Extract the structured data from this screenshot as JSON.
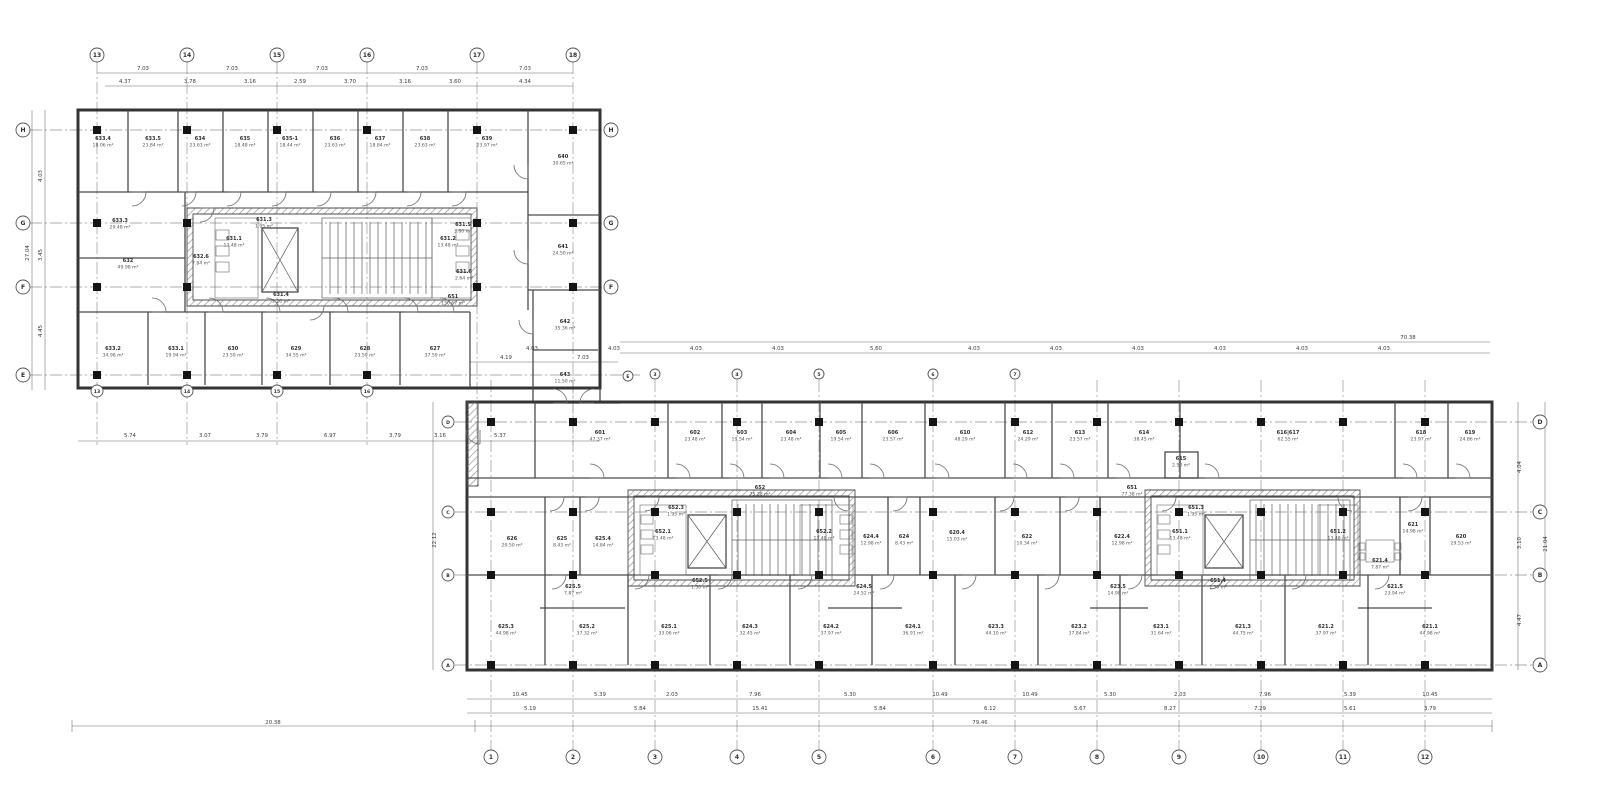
{
  "plan": {
    "rooms": [
      {
        "id": "633.4",
        "area": "18.06 m²",
        "x": 103,
        "y": 140
      },
      {
        "id": "633.5",
        "area": "23.84 m²",
        "x": 153,
        "y": 140
      },
      {
        "id": "634",
        "area": "23.63 m²",
        "x": 200,
        "y": 140
      },
      {
        "id": "635",
        "area": "18.48 m²",
        "x": 245,
        "y": 140
      },
      {
        "id": "635-1",
        "area": "18.44 m²",
        "x": 290,
        "y": 140
      },
      {
        "id": "636",
        "area": "23.63 m²",
        "x": 335,
        "y": 140
      },
      {
        "id": "637",
        "area": "18.84 m²",
        "x": 380,
        "y": 140
      },
      {
        "id": "638",
        "area": "23.63 m²",
        "x": 425,
        "y": 140
      },
      {
        "id": "639",
        "area": "23.97 m²",
        "x": 487,
        "y": 140
      },
      {
        "id": "640",
        "area": "30.65 m²",
        "x": 563,
        "y": 158
      },
      {
        "id": "633.3",
        "area": "29.48 m²",
        "x": 120,
        "y": 222
      },
      {
        "id": "632",
        "area": "49.98 m²",
        "x": 128,
        "y": 262
      },
      {
        "id": "632.6",
        "area": "7.84 m²",
        "x": 201,
        "y": 258
      },
      {
        "id": "631.1",
        "area": "13.48 m²",
        "x": 234,
        "y": 240
      },
      {
        "id": "631.2",
        "area": "13.48 m²",
        "x": 448,
        "y": 240
      },
      {
        "id": "631.3",
        "area": "1.95 m²",
        "x": 264,
        "y": 221
      },
      {
        "id": "631.4",
        "area": "1.20 m²",
        "x": 281,
        "y": 296
      },
      {
        "id": "631.5",
        "area": "3.80 m²",
        "x": 463,
        "y": 226
      },
      {
        "id": "631.6",
        "area": "2.64 m²",
        "x": 464,
        "y": 273
      },
      {
        "id": "651",
        "area": "130.67 m²",
        "x": 453,
        "y": 298
      },
      {
        "id": "633.2",
        "area": "34.98 m²",
        "x": 113,
        "y": 350
      },
      {
        "id": "633.1",
        "area": "19.94 m²",
        "x": 176,
        "y": 350
      },
      {
        "id": "630",
        "area": "23.59 m²",
        "x": 233,
        "y": 350
      },
      {
        "id": "629",
        "area": "34.55 m²",
        "x": 296,
        "y": 350
      },
      {
        "id": "628",
        "area": "23.59 m²",
        "x": 365,
        "y": 350
      },
      {
        "id": "627",
        "area": "37.59 m²",
        "x": 435,
        "y": 350
      },
      {
        "id": "641",
        "area": "24.50 m²",
        "x": 563,
        "y": 248
      },
      {
        "id": "642",
        "area": "35.36 m²",
        "x": 565,
        "y": 323
      },
      {
        "id": "643",
        "area": "11.50 m²",
        "x": 565,
        "y": 376
      },
      {
        "id": "601",
        "area": "47.37 m²",
        "x": 600,
        "y": 434
      },
      {
        "id": "602",
        "area": "23.48 m²",
        "x": 695,
        "y": 434
      },
      {
        "id": "603",
        "area": "19.54 m²",
        "x": 742,
        "y": 434
      },
      {
        "id": "604",
        "area": "23.48 m²",
        "x": 791,
        "y": 434
      },
      {
        "id": "605",
        "area": "19.54 m²",
        "x": 841,
        "y": 434
      },
      {
        "id": "606",
        "area": "23.57 m²",
        "x": 893,
        "y": 434
      },
      {
        "id": "610",
        "area": "48.29 m²",
        "x": 965,
        "y": 434
      },
      {
        "id": "612",
        "area": "24.29 m²",
        "x": 1028,
        "y": 434
      },
      {
        "id": "613",
        "area": "23.57 m²",
        "x": 1080,
        "y": 434
      },
      {
        "id": "614",
        "area": "38.45 m²",
        "x": 1144,
        "y": 434
      },
      {
        "id": "615",
        "area": "2.50 m²",
        "x": 1181,
        "y": 460
      },
      {
        "id": "616|617",
        "area": "62.55 m²",
        "x": 1288,
        "y": 434
      },
      {
        "id": "618",
        "area": "23.97 m²",
        "x": 1421,
        "y": 434
      },
      {
        "id": "619",
        "area": "24.86 m²",
        "x": 1470,
        "y": 434
      },
      {
        "id": "626",
        "area": "29.50 m²",
        "x": 512,
        "y": 540
      },
      {
        "id": "625",
        "area": "8.43 m²",
        "x": 562,
        "y": 540
      },
      {
        "id": "625.4",
        "area": "14.84 m²",
        "x": 603,
        "y": 540
      },
      {
        "id": "652",
        "area": "75.38 m²",
        "x": 760,
        "y": 489
      },
      {
        "id": "652.1",
        "area": "13.48 m²",
        "x": 663,
        "y": 533
      },
      {
        "id": "652.2",
        "area": "13.48 m²",
        "x": 824,
        "y": 533
      },
      {
        "id": "652.3",
        "area": "1.95 m²",
        "x": 676,
        "y": 509
      },
      {
        "id": "652.5",
        "area": "1.50 m²",
        "x": 700,
        "y": 582
      },
      {
        "id": "624.4",
        "area": "12.98 m²",
        "x": 871,
        "y": 538
      },
      {
        "id": "624",
        "area": "8.43 m²",
        "x": 904,
        "y": 538
      },
      {
        "id": "620.4",
        "area": "15.03 m²",
        "x": 957,
        "y": 534
      },
      {
        "id": "622",
        "area": "10.34 m²",
        "x": 1027,
        "y": 538
      },
      {
        "id": "622.4",
        "area": "12.98 m²",
        "x": 1122,
        "y": 538
      },
      {
        "id": "651",
        "area": "77.38 m²",
        "x": 1132,
        "y": 489
      },
      {
        "id": "651.1",
        "area": "13.48 m²",
        "x": 1180,
        "y": 533
      },
      {
        "id": "651.2",
        "area": "13.48 m²",
        "x": 1338,
        "y": 533
      },
      {
        "id": "651.3",
        "area": "1.95 m²",
        "x": 1196,
        "y": 509
      },
      {
        "id": "651.4",
        "area": "1.50 m²",
        "x": 1218,
        "y": 582
      },
      {
        "id": "621.4",
        "area": "7.87 m²",
        "x": 1380,
        "y": 562
      },
      {
        "id": "621",
        "area": "14.98 m²",
        "x": 1413,
        "y": 526
      },
      {
        "id": "620",
        "area": "29.53 m²",
        "x": 1461,
        "y": 538
      },
      {
        "id": "625.5",
        "area": "7.87 m²",
        "x": 573,
        "y": 588
      },
      {
        "id": "624.5",
        "area": "24.52 m²",
        "x": 864,
        "y": 588
      },
      {
        "id": "623.5",
        "area": "14.98 m²",
        "x": 1118,
        "y": 588
      },
      {
        "id": "621.5",
        "area": "23.94 m²",
        "x": 1395,
        "y": 588
      },
      {
        "id": "625.3",
        "area": "44.98 m²",
        "x": 506,
        "y": 628
      },
      {
        "id": "625.2",
        "area": "37.32 m²",
        "x": 587,
        "y": 628
      },
      {
        "id": "625.1",
        "area": "33.06 m²",
        "x": 669,
        "y": 628
      },
      {
        "id": "624.3",
        "area": "32.45 m²",
        "x": 750,
        "y": 628
      },
      {
        "id": "624.2",
        "area": "37.97 m²",
        "x": 831,
        "y": 628
      },
      {
        "id": "624.1",
        "area": "36.91 m²",
        "x": 913,
        "y": 628
      },
      {
        "id": "623.3",
        "area": "44.10 m²",
        "x": 996,
        "y": 628
      },
      {
        "id": "623.2",
        "area": "37.84 m²",
        "x": 1079,
        "y": 628
      },
      {
        "id": "623.1",
        "area": "31.64 m²",
        "x": 1161,
        "y": 628
      },
      {
        "id": "621.3",
        "area": "44.75 m²",
        "x": 1243,
        "y": 628
      },
      {
        "id": "621.2",
        "area": "37.97 m²",
        "x": 1326,
        "y": 628
      },
      {
        "id": "621.1",
        "area": "44.98 m²",
        "x": 1430,
        "y": 628
      }
    ],
    "bubbles": [
      {
        "t": "13",
        "x": 97,
        "y": 55,
        "r": 7
      },
      {
        "t": "14",
        "x": 187,
        "y": 55,
        "r": 7
      },
      {
        "t": "15",
        "x": 277,
        "y": 55,
        "r": 7
      },
      {
        "t": "16",
        "x": 367,
        "y": 55,
        "r": 7
      },
      {
        "t": "17",
        "x": 477,
        "y": 55,
        "r": 7
      },
      {
        "t": "18",
        "x": 573,
        "y": 55,
        "r": 7
      },
      {
        "t": "13",
        "x": 97,
        "y": 391,
        "r": 6
      },
      {
        "t": "14",
        "x": 187,
        "y": 391,
        "r": 6
      },
      {
        "t": "15",
        "x": 277,
        "y": 391,
        "r": 6
      },
      {
        "t": "16",
        "x": 367,
        "y": 391,
        "r": 6
      },
      {
        "t": "H",
        "x": 23,
        "y": 130,
        "r": 7
      },
      {
        "t": "G",
        "x": 23,
        "y": 223,
        "r": 7
      },
      {
        "t": "F",
        "x": 23,
        "y": 287,
        "r": 7
      },
      {
        "t": "E",
        "x": 23,
        "y": 375,
        "r": 7
      },
      {
        "t": "H",
        "x": 611,
        "y": 130,
        "r": 7
      },
      {
        "t": "G",
        "x": 611,
        "y": 223,
        "r": 7
      },
      {
        "t": "F",
        "x": 611,
        "y": 287,
        "r": 7
      },
      {
        "t": "E",
        "x": 628,
        "y": 376,
        "r": 5
      },
      {
        "t": "3",
        "x": 655,
        "y": 374,
        "r": 5
      },
      {
        "t": "4",
        "x": 737,
        "y": 374,
        "r": 5
      },
      {
        "t": "5",
        "x": 819,
        "y": 374,
        "r": 5
      },
      {
        "t": "6",
        "x": 933,
        "y": 374,
        "r": 5
      },
      {
        "t": "7",
        "x": 1015,
        "y": 374,
        "r": 5
      },
      {
        "t": "1",
        "x": 491,
        "y": 757,
        "r": 7
      },
      {
        "t": "2",
        "x": 573,
        "y": 757,
        "r": 7
      },
      {
        "t": "3",
        "x": 655,
        "y": 757,
        "r": 7
      },
      {
        "t": "4",
        "x": 737,
        "y": 757,
        "r": 7
      },
      {
        "t": "5",
        "x": 819,
        "y": 757,
        "r": 7
      },
      {
        "t": "6",
        "x": 933,
        "y": 757,
        "r": 7
      },
      {
        "t": "7",
        "x": 1015,
        "y": 757,
        "r": 7
      },
      {
        "t": "8",
        "x": 1097,
        "y": 757,
        "r": 7
      },
      {
        "t": "9",
        "x": 1179,
        "y": 757,
        "r": 7
      },
      {
        "t": "10",
        "x": 1261,
        "y": 757,
        "r": 7
      },
      {
        "t": "11",
        "x": 1343,
        "y": 757,
        "r": 7
      },
      {
        "t": "12",
        "x": 1425,
        "y": 757,
        "r": 7
      },
      {
        "t": "D",
        "x": 1540,
        "y": 422,
        "r": 7
      },
      {
        "t": "C",
        "x": 1540,
        "y": 512,
        "r": 7
      },
      {
        "t": "B",
        "x": 1540,
        "y": 575,
        "r": 7
      },
      {
        "t": "A",
        "x": 1540,
        "y": 665,
        "r": 7
      },
      {
        "t": "D",
        "x": 448,
        "y": 422,
        "r": 6
      },
      {
        "t": "C",
        "x": 448,
        "y": 512,
        "r": 6
      },
      {
        "t": "B",
        "x": 448,
        "y": 575,
        "r": 6
      },
      {
        "t": "A",
        "x": 448,
        "y": 665,
        "r": 6
      }
    ],
    "dims": [
      {
        "t": "7.03",
        "x": 143,
        "y": 70
      },
      {
        "t": "7.03",
        "x": 232,
        "y": 70
      },
      {
        "t": "7.03",
        "x": 322,
        "y": 70
      },
      {
        "t": "7.03",
        "x": 422,
        "y": 70
      },
      {
        "t": "7.03",
        "x": 525,
        "y": 70
      },
      {
        "t": "4.37",
        "x": 125,
        "y": 83
      },
      {
        "t": "3.78",
        "x": 190,
        "y": 83
      },
      {
        "t": "3.16",
        "x": 250,
        "y": 83
      },
      {
        "t": "2.59",
        "x": 300,
        "y": 83
      },
      {
        "t": "3.70",
        "x": 350,
        "y": 83
      },
      {
        "t": "3.16",
        "x": 405,
        "y": 83
      },
      {
        "t": "3.60",
        "x": 455,
        "y": 83
      },
      {
        "t": "4.34",
        "x": 525,
        "y": 83
      },
      {
        "t": "4.03",
        "x": 42,
        "y": 176,
        "v": 1
      },
      {
        "t": "3.45",
        "x": 42,
        "y": 255,
        "v": 1
      },
      {
        "t": "4.45",
        "x": 42,
        "y": 331,
        "v": 1
      },
      {
        "t": "27.04",
        "x": 29,
        "y": 253,
        "v": 1
      },
      {
        "t": "5.74",
        "x": 130,
        "y": 437
      },
      {
        "t": "3.07",
        "x": 205,
        "y": 437
      },
      {
        "t": "3.79",
        "x": 262,
        "y": 437
      },
      {
        "t": "6.97",
        "x": 330,
        "y": 437
      },
      {
        "t": "3.79",
        "x": 395,
        "y": 437
      },
      {
        "t": "3.16",
        "x": 440,
        "y": 437
      },
      {
        "t": "5.37",
        "x": 500,
        "y": 437
      },
      {
        "t": "4.19",
        "x": 506,
        "y": 359
      },
      {
        "t": "7.03",
        "x": 583,
        "y": 359
      },
      {
        "t": "4.03",
        "x": 532,
        "y": 350
      },
      {
        "t": "4.03",
        "x": 614,
        "y": 350
      },
      {
        "t": "4.03",
        "x": 696,
        "y": 350
      },
      {
        "t": "4.03",
        "x": 778,
        "y": 350
      },
      {
        "t": "5.60",
        "x": 876,
        "y": 350
      },
      {
        "t": "4.03",
        "x": 974,
        "y": 350
      },
      {
        "t": "4.03",
        "x": 1056,
        "y": 350
      },
      {
        "t": "4.03",
        "x": 1138,
        "y": 350
      },
      {
        "t": "4.03",
        "x": 1220,
        "y": 350
      },
      {
        "t": "4.03",
        "x": 1302,
        "y": 350
      },
      {
        "t": "4.03",
        "x": 1384,
        "y": 350
      },
      {
        "t": "70.38",
        "x": 1408,
        "y": 339
      },
      {
        "t": "10.45",
        "x": 520,
        "y": 696
      },
      {
        "t": "5.39",
        "x": 600,
        "y": 696
      },
      {
        "t": "2.03",
        "x": 672,
        "y": 696
      },
      {
        "t": "7.96",
        "x": 755,
        "y": 696
      },
      {
        "t": "5.30",
        "x": 850,
        "y": 696
      },
      {
        "t": "10.49",
        "x": 940,
        "y": 696
      },
      {
        "t": "10.49",
        "x": 1030,
        "y": 696
      },
      {
        "t": "5.30",
        "x": 1110,
        "y": 696
      },
      {
        "t": "2.03",
        "x": 1180,
        "y": 696
      },
      {
        "t": "7.96",
        "x": 1265,
        "y": 696
      },
      {
        "t": "5.39",
        "x": 1350,
        "y": 696
      },
      {
        "t": "10.45",
        "x": 1430,
        "y": 696
      },
      {
        "t": "5.19",
        "x": 530,
        "y": 710
      },
      {
        "t": "5.84",
        "x": 640,
        "y": 710
      },
      {
        "t": "15.41",
        "x": 760,
        "y": 710
      },
      {
        "t": "5.84",
        "x": 880,
        "y": 710
      },
      {
        "t": "6.12",
        "x": 990,
        "y": 710
      },
      {
        "t": "5.67",
        "x": 1080,
        "y": 710
      },
      {
        "t": "8.27",
        "x": 1170,
        "y": 710
      },
      {
        "t": "7.29",
        "x": 1260,
        "y": 710
      },
      {
        "t": "5.61",
        "x": 1350,
        "y": 710
      },
      {
        "t": "3.79",
        "x": 1430,
        "y": 710
      },
      {
        "t": "20.38",
        "x": 273,
        "y": 724
      },
      {
        "t": "79.46",
        "x": 980,
        "y": 724
      },
      {
        "t": "4.04",
        "x": 1521,
        "y": 467,
        "v": 1
      },
      {
        "t": "3.10",
        "x": 1521,
        "y": 543,
        "v": 1
      },
      {
        "t": "4.47",
        "x": 1521,
        "y": 620,
        "v": 1
      },
      {
        "t": "21.04",
        "x": 1547,
        "y": 544,
        "v": 1
      },
      {
        "t": "22.12",
        "x": 436,
        "y": 540,
        "v": 1
      }
    ],
    "columns": [
      {
        "xs": [
          97,
          187,
          277,
          367,
          477,
          573
        ],
        "ys": [
          130
        ]
      },
      {
        "xs": [
          97,
          187,
          477,
          573
        ],
        "ys": [
          223,
          287
        ]
      },
      {
        "xs": [
          97,
          187,
          277,
          367
        ],
        "ys": [
          375
        ]
      },
      {
        "xs": [
          491,
          573,
          655,
          737,
          819,
          933,
          1015,
          1097,
          1179,
          1261,
          1343,
          1425
        ],
        "ys": [
          422,
          512,
          575,
          665
        ]
      }
    ]
  }
}
